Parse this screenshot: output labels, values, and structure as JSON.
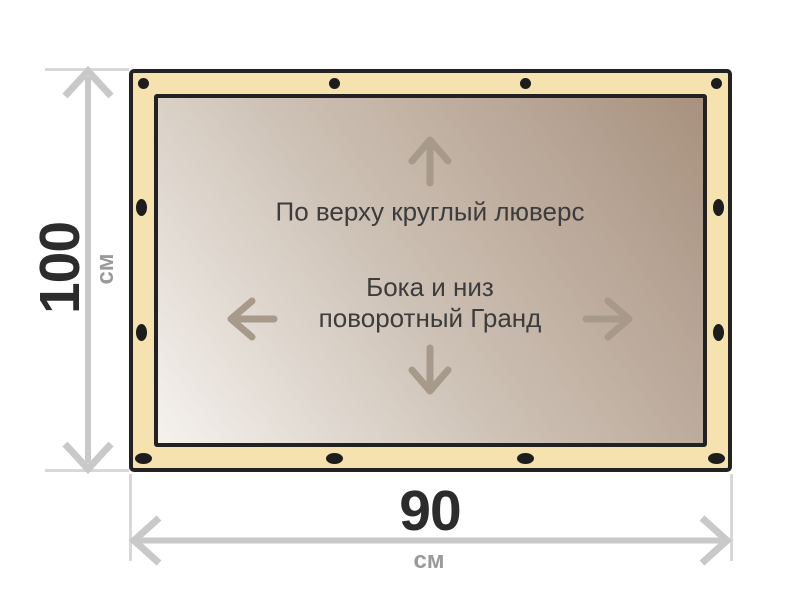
{
  "banner": {
    "top_note": "По верху круглый люверс",
    "center_note_line1": "Бока и низ",
    "center_note_line2": "поворотный Гранд",
    "colors": {
      "frame_outline": "#222222",
      "hem_band": "#f5e2ae",
      "canvas_gradient_light": "#f5f2ee",
      "canvas_gradient_dark": "#a8917e",
      "grommet": "#1d1d1d",
      "direction_arrow": "#a79a8a"
    },
    "grommet_counts": {
      "top": 4,
      "bottom": 4,
      "left": 2,
      "right": 2
    }
  },
  "dimensions": {
    "height": {
      "value": "100",
      "unit": "см"
    },
    "width": {
      "value": "90",
      "unit": "см"
    },
    "colors": {
      "dimension_line": "#c9c9c9",
      "extension_line": "#d8d8d8",
      "value_text": "#2c2c2c",
      "unit_text": "#9a9a9a"
    }
  }
}
